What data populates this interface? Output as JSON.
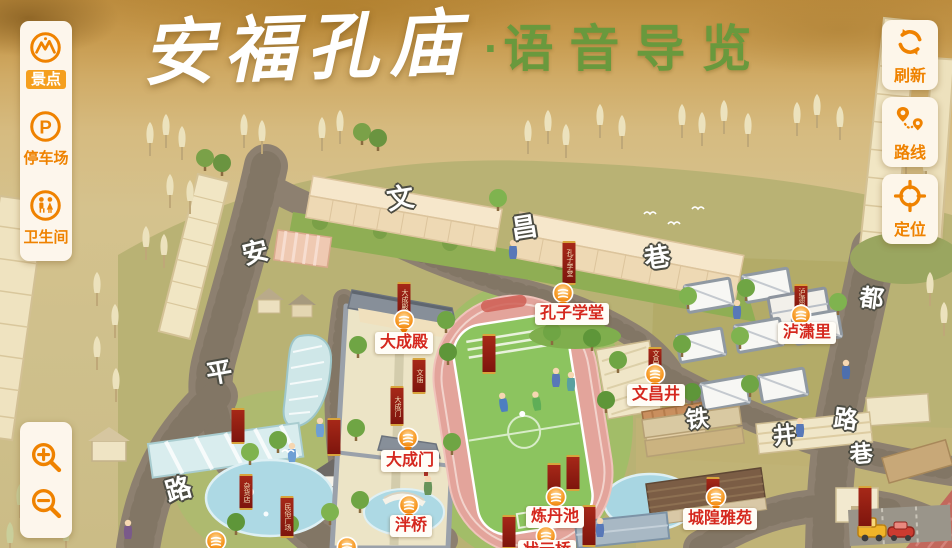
{
  "title": {
    "main": "安福孔庙",
    "separator": "·",
    "sub": "语音导览"
  },
  "left_toolbar": {
    "items": [
      {
        "id": "scenic",
        "label": "景点",
        "icon": "scenic-spot-icon",
        "selected": true
      },
      {
        "id": "parking",
        "label": "停车场",
        "icon": "parking-icon",
        "selected": false
      },
      {
        "id": "restroom",
        "label": "卫生间",
        "icon": "restroom-icon",
        "selected": false
      }
    ]
  },
  "right_toolbar": {
    "items": [
      {
        "id": "refresh",
        "label": "刷新",
        "icon": "refresh-icon"
      },
      {
        "id": "route",
        "label": "路线",
        "icon": "route-icon"
      },
      {
        "id": "locate",
        "label": "定位",
        "icon": "locate-icon"
      }
    ]
  },
  "zoom_controls": {
    "items": [
      {
        "id": "zoom-in",
        "icon": "zoom-in-icon"
      },
      {
        "id": "zoom-out",
        "icon": "zoom-out-icon"
      }
    ]
  },
  "map": {
    "streets": [
      {
        "name": "文昌巷",
        "chars": [
          {
            "ch": "文",
            "x": 400,
            "y": 196,
            "r": -9,
            "s": 27
          },
          {
            "ch": "昌",
            "x": 524,
            "y": 226,
            "r": -9,
            "s": 26
          },
          {
            "ch": "巷",
            "x": 657,
            "y": 256,
            "r": -9,
            "s": 26
          }
        ]
      },
      {
        "name": "安平路",
        "chars": [
          {
            "ch": "安",
            "x": 255,
            "y": 251,
            "r": -14,
            "s": 26
          },
          {
            "ch": "平",
            "x": 219,
            "y": 371,
            "r": -10,
            "s": 26
          },
          {
            "ch": "路",
            "x": 178,
            "y": 488,
            "r": -16,
            "s": 26
          }
        ]
      },
      {
        "name": "铁井巷",
        "chars": [
          {
            "ch": "铁",
            "x": 697,
            "y": 417,
            "r": -6,
            "s": 23
          },
          {
            "ch": "井",
            "x": 784,
            "y": 433,
            "r": -6,
            "s": 23
          },
          {
            "ch": "巷",
            "x": 861,
            "y": 452,
            "r": -6,
            "s": 23
          }
        ]
      },
      {
        "name": "都路",
        "chars": [
          {
            "ch": "都",
            "x": 872,
            "y": 296,
            "r": 7,
            "s": 24
          },
          {
            "ch": "路",
            "x": 846,
            "y": 417,
            "r": 7,
            "s": 24
          }
        ]
      }
    ],
    "pois": [
      {
        "name": "大成殿",
        "marker": {
          "x": 404,
          "y": 320
        },
        "label": {
          "x": 404,
          "y": 332
        }
      },
      {
        "name": "孔子学堂",
        "marker": {
          "x": 563,
          "y": 293
        },
        "label": {
          "x": 572,
          "y": 303
        }
      },
      {
        "name": "泸潇里",
        "marker": {
          "x": 801,
          "y": 315
        },
        "label": {
          "x": 807,
          "y": 322
        }
      },
      {
        "name": "文昌井",
        "marker": {
          "x": 655,
          "y": 374
        },
        "label": {
          "x": 656,
          "y": 384
        }
      },
      {
        "name": "大成门",
        "marker": {
          "x": 408,
          "y": 438
        },
        "label": {
          "x": 410,
          "y": 450
        }
      },
      {
        "name": "泮桥",
        "marker": {
          "x": 409,
          "y": 505
        },
        "label": {
          "x": 411,
          "y": 515
        }
      },
      {
        "name": "炼丹池",
        "marker": {
          "x": 556,
          "y": 497
        },
        "label": {
          "x": 555,
          "y": 506
        }
      },
      {
        "name": "城隍雅苑",
        "marker": {
          "x": 716,
          "y": 497
        },
        "label": {
          "x": 720,
          "y": 508
        }
      },
      {
        "name": "状元桥",
        "marker": {
          "x": 546,
          "y": 536
        },
        "label": {
          "x": 547,
          "y": 540
        }
      },
      {
        "name": "",
        "marker": {
          "x": 216,
          "y": 541
        },
        "label": null
      },
      {
        "name": "",
        "marker": {
          "x": 347,
          "y": 547
        },
        "label": null
      }
    ],
    "banners": [
      {
        "x": 404,
        "y": 282,
        "h": 30,
        "text": "大成殿"
      },
      {
        "x": 569,
        "y": 241,
        "h": 40,
        "text": "孔子学堂"
      },
      {
        "x": 801,
        "y": 284,
        "h": 24,
        "text": "泸潇里"
      },
      {
        "x": 655,
        "y": 347,
        "h": 22,
        "text": "文昌井"
      },
      {
        "x": 419,
        "y": 358,
        "h": 32,
        "text": "文庙"
      },
      {
        "x": 397,
        "y": 386,
        "h": 36,
        "text": "大成门"
      },
      {
        "x": 489,
        "y": 334,
        "h": 36,
        "text": ""
      },
      {
        "x": 238,
        "y": 408,
        "h": 32,
        "text": ""
      },
      {
        "x": 246,
        "y": 474,
        "h": 32,
        "text": "杂货店"
      },
      {
        "x": 287,
        "y": 496,
        "h": 38,
        "text": "民俗广场"
      },
      {
        "x": 334,
        "y": 418,
        "h": 34,
        "text": ""
      },
      {
        "x": 554,
        "y": 463,
        "h": 30,
        "text": ""
      },
      {
        "x": 573,
        "y": 455,
        "h": 32,
        "text": ""
      },
      {
        "x": 509,
        "y": 515,
        "h": 30,
        "text": ""
      },
      {
        "x": 589,
        "y": 505,
        "h": 38,
        "text": ""
      },
      {
        "x": 713,
        "y": 477,
        "h": 16,
        "text": ""
      },
      {
        "x": 865,
        "y": 486,
        "h": 38,
        "text": ""
      }
    ]
  },
  "colors": {
    "accent_orange": "#ef8200",
    "poi_red": "#d5281e",
    "title_green": "#69993d",
    "banner_red": "#8e1a12"
  }
}
